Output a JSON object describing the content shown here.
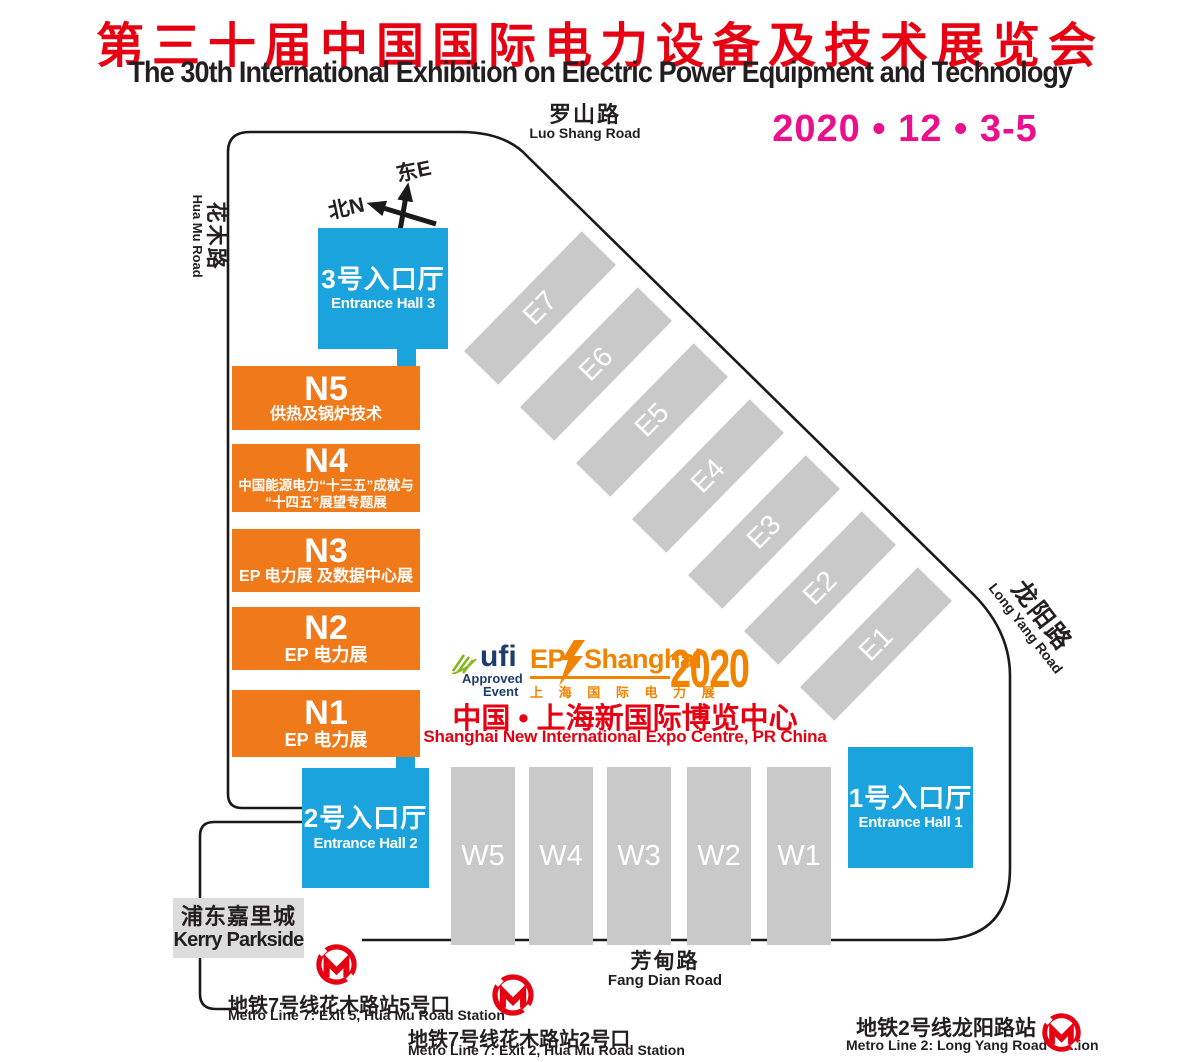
{
  "header": {
    "title_cn": "第三十届中国国际电力设备及技术展览会",
    "title_en": "The 30th International Exhibition on Electric Power Equipment and Technology",
    "date": "2020 • 12 • 3-5"
  },
  "compass": {
    "east": "东E",
    "north": "北N"
  },
  "roads": {
    "luoshang_cn": "罗山路",
    "luoshang_en": "Luo Shang Road",
    "huamu_cn": "花木路",
    "huamu_en": "Hua Mu Road",
    "longyang_cn": "龙阳路",
    "longyang_en": "Long Yang Road",
    "fangdian_cn": "芳甸路",
    "fangdian_en": "Fang Dian Road"
  },
  "entrances": {
    "hall3_cn": "3号入口厅",
    "hall3_en": "Entrance Hall 3",
    "hall2_cn": "2号入口厅",
    "hall2_en": "Entrance Hall 2",
    "hall1_cn": "1号入口厅",
    "hall1_en": "Entrance Hall 1"
  },
  "n_halls": {
    "n5_id": "N5",
    "n5_sub": "供热及锅炉技术",
    "n4_id": "N4",
    "n4_sub1": "中国能源电力“十三五”成就与",
    "n4_sub2": "“十四五”展望专题展",
    "n3_id": "N3",
    "n3_sub": "EP 电力展 及数据中心展",
    "n2_id": "N2",
    "n2_sub": "EP 电力展",
    "n1_id": "N1",
    "n1_sub": "EP 电力展"
  },
  "e_halls": [
    "E7",
    "E6",
    "E5",
    "E4",
    "E3",
    "E2",
    "E1"
  ],
  "w_halls": [
    "W5",
    "W4",
    "W3",
    "W2",
    "W1"
  ],
  "logos": {
    "ufi_name": "ufi",
    "ufi_line1": "Approved",
    "ufi_line2": "Event",
    "ep": "EP",
    "shanghai": "Shanghai",
    "ep_cn": "上 海 国 际 电 力 展",
    "year": "2020"
  },
  "venue": {
    "cn": "中国 • 上海新国际博览中心",
    "en": "Shanghai New International Expo Centre, PR China"
  },
  "kerry": {
    "cn": "浦东嘉里城",
    "en": "Kerry Parkside"
  },
  "metro": [
    {
      "cn": "地铁7号线花木路站5号口",
      "en": "Metro Line 7: Exit 5, Hua Mu Road Station"
    },
    {
      "cn": "地铁7号线花木路站2号口",
      "en": "Metro Line 7: Exit 2, Hua Mu Road Station"
    },
    {
      "cn": "地铁2号线龙阳路站",
      "en": "Metro Line 2: Long Yang Road Station"
    }
  ],
  "colors": {
    "title_red": "#e60012",
    "date_magenta": "#ea108b",
    "entrance_blue": "#1aa3dc",
    "hall_orange": "#f0791a",
    "hall_gray": "#c9c9c9",
    "kerry_gray": "#dcdcdc",
    "metro_red": "#e60012",
    "ufi_navy": "#1e3c6e",
    "ufi_green": "#85b71e",
    "ep_orange": "#f08300"
  }
}
